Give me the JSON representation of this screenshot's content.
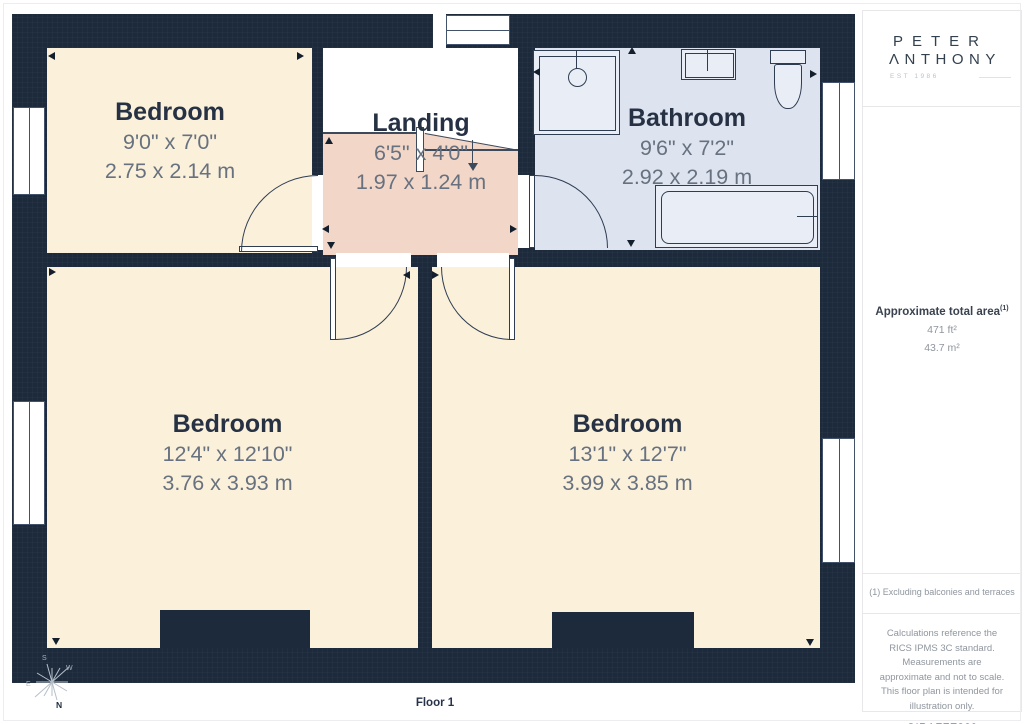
{
  "colors": {
    "wall": "#1d2a3b",
    "bedroom_fill": "#fbf0da",
    "landing_fill": "#f2d7c9",
    "bathroom_fill": "#dde3ef",
    "title_text": "#263244",
    "dimension_text": "#67717f"
  },
  "rooms": {
    "bedroom_top_left": {
      "name": "Bedroom",
      "imperial": "9'0\" x 7'0\"",
      "metric": "2.75 x 2.14 m"
    },
    "landing": {
      "name": "Landing",
      "imperial": "6'5\" x 4'0\"",
      "metric": "1.97 x 1.24 m"
    },
    "bathroom": {
      "name": "Bathroom",
      "imperial": "9'6\" x 7'2\"",
      "metric": "2.92 x 2.19 m"
    },
    "bedroom_bottom_left": {
      "name": "Bedroom",
      "imperial": "12'4\" x 12'10\"",
      "metric": "3.76 x 3.93 m"
    },
    "bedroom_bottom_right": {
      "name": "Bedroom",
      "imperial": "13'1\" x 12'7\"",
      "metric": "3.99 x 3.85 m"
    }
  },
  "floor_label": "Floor 1",
  "compass": {
    "north": "N",
    "south": "S",
    "east": "E",
    "west": "W"
  },
  "sidebar": {
    "logo": {
      "line1": "PETER",
      "line2": "ΛNTHONY",
      "tagline": "EST 1986"
    },
    "area": {
      "title": "Approximate total area",
      "footnote_ref": "(1)",
      "imperial": "471 ft²",
      "metric": "43.7 m²"
    },
    "footnote": "(1) Excluding balconies and terraces",
    "disclaimer": "Calculations reference the RICS IPMS 3C standard. Measurements are approximate and not to scale. This floor plan is intended for illustration only.",
    "credit": {
      "brand": "GIRAFFE",
      "suffix": "360"
    }
  }
}
